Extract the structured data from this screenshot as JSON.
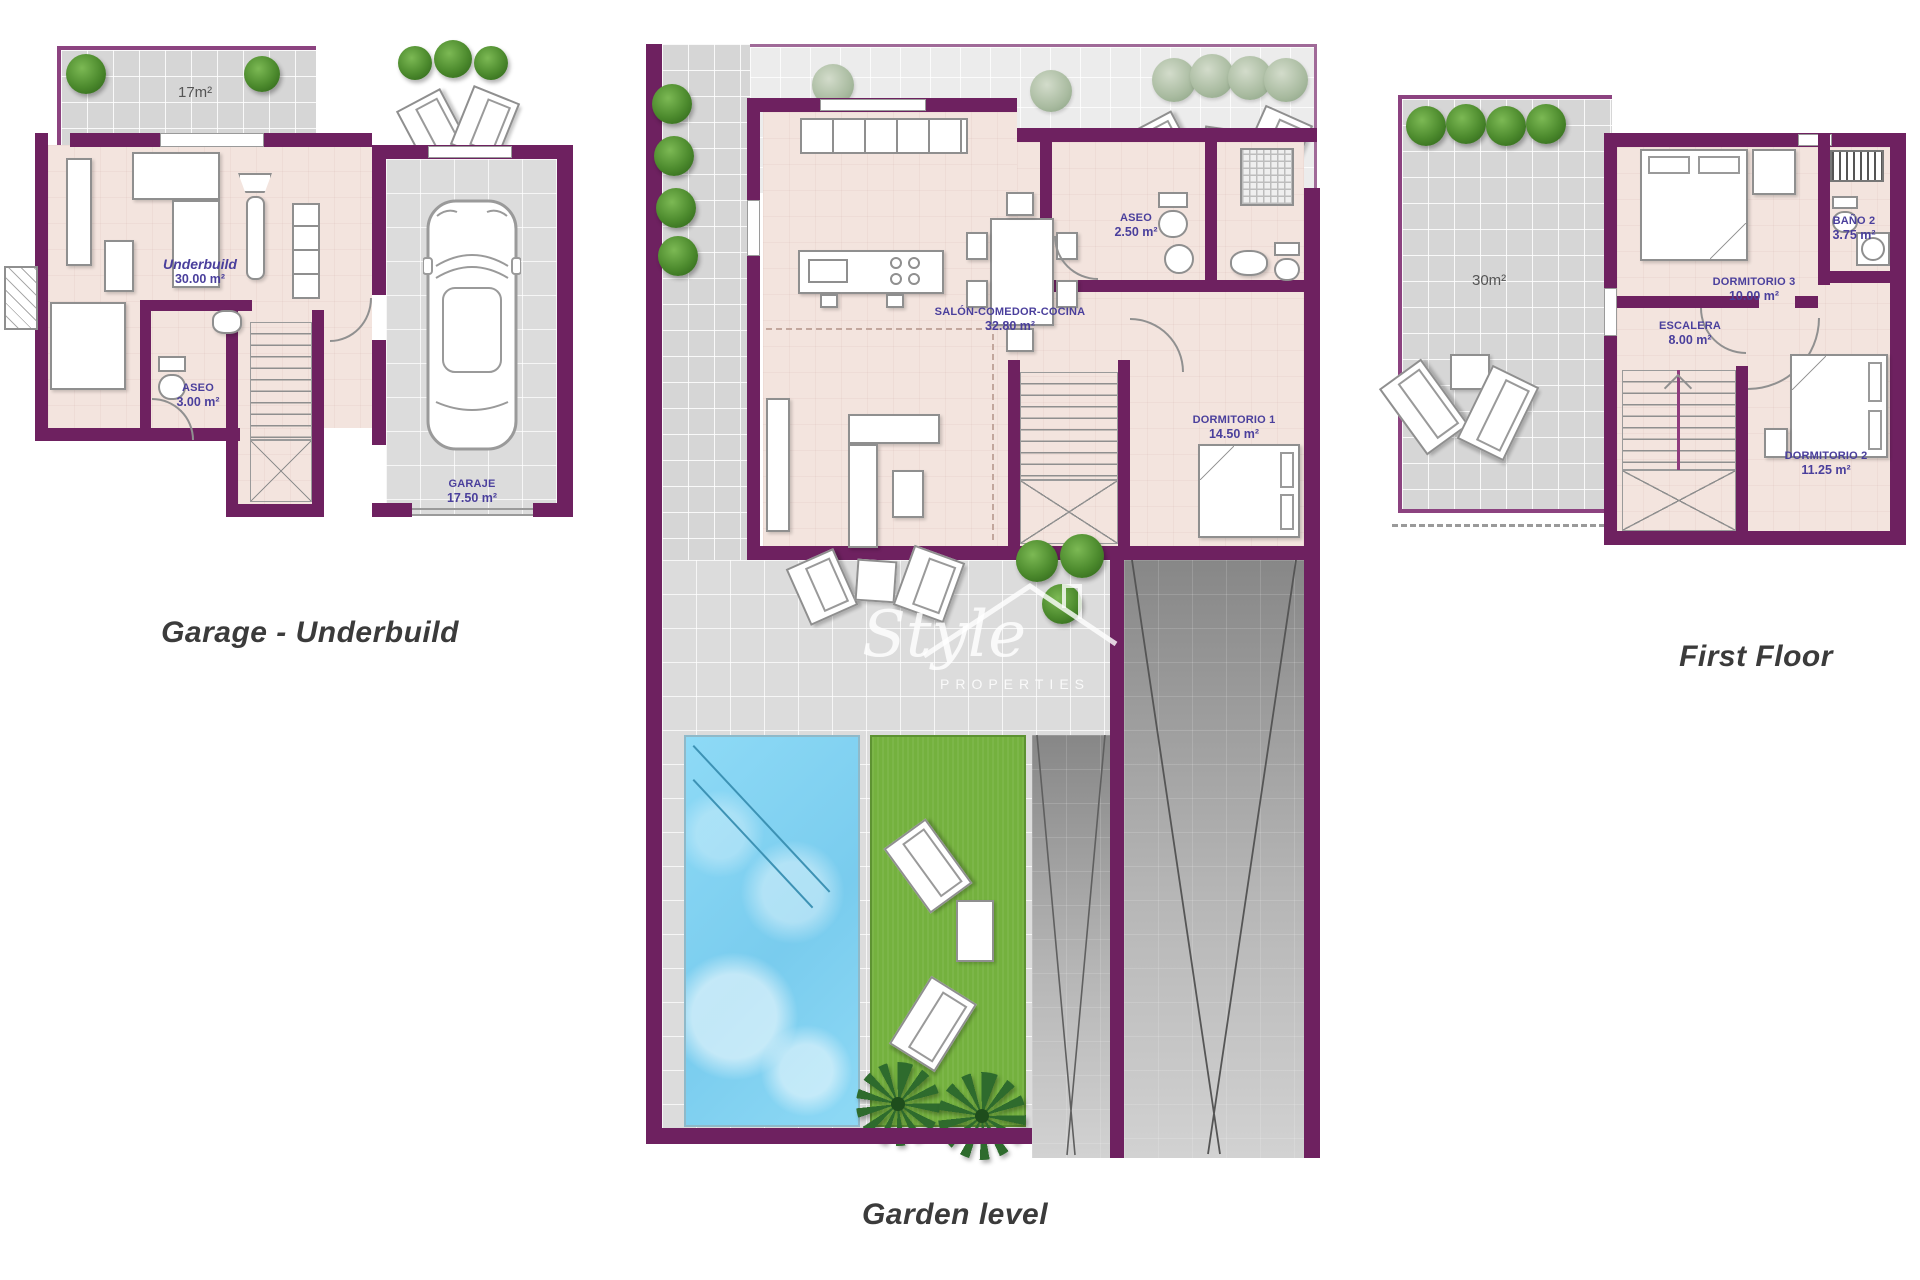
{
  "captions": {
    "garage_underbuild": "Garage - Underbuild",
    "garden_level": "Garden level",
    "first_floor": "First Floor"
  },
  "watermark": {
    "name": "Style",
    "subtitle": "PROPERTIES"
  },
  "garage_plan": {
    "terrace_area": "17m²",
    "underbuild": {
      "name": "Underbuild",
      "area": "30.00 m²"
    },
    "aseo": {
      "name": "ASEO",
      "area": "3.00 m²"
    },
    "garaje": {
      "name": "GARAJE",
      "area": "17.50 m²"
    }
  },
  "garden_plan": {
    "salon": {
      "name": "SALÓN-COMEDOR-COCINA",
      "area": "32.80 m²"
    },
    "aseo": {
      "name": "ASEO",
      "area": "2.50 m²"
    },
    "dormitorio1": {
      "name": "DORMITORIO 1",
      "area": "14.50 m²"
    }
  },
  "first_floor_plan": {
    "terrace_area": "30m²",
    "dormitorio3": {
      "name": "DORMITORIO 3",
      "area": "10.00 m²"
    },
    "bano2": {
      "name": "BAÑO 2",
      "area": "3.75 m²"
    },
    "escalera": {
      "name": "ESCALERA",
      "area": "8.00 m²"
    },
    "dormitorio2": {
      "name": "DORMITORIO 2",
      "area": "11.25 m²"
    }
  },
  "colors": {
    "wall_purple": "#6e2160",
    "wall_outline": "#8c4380",
    "floor_pink": "#f3e4de",
    "terrace_gray": "#d6d6d6",
    "pool_blue": "#7fd0f2",
    "grass_green": "#74b13e",
    "label_blue": "#4a3f9c"
  }
}
